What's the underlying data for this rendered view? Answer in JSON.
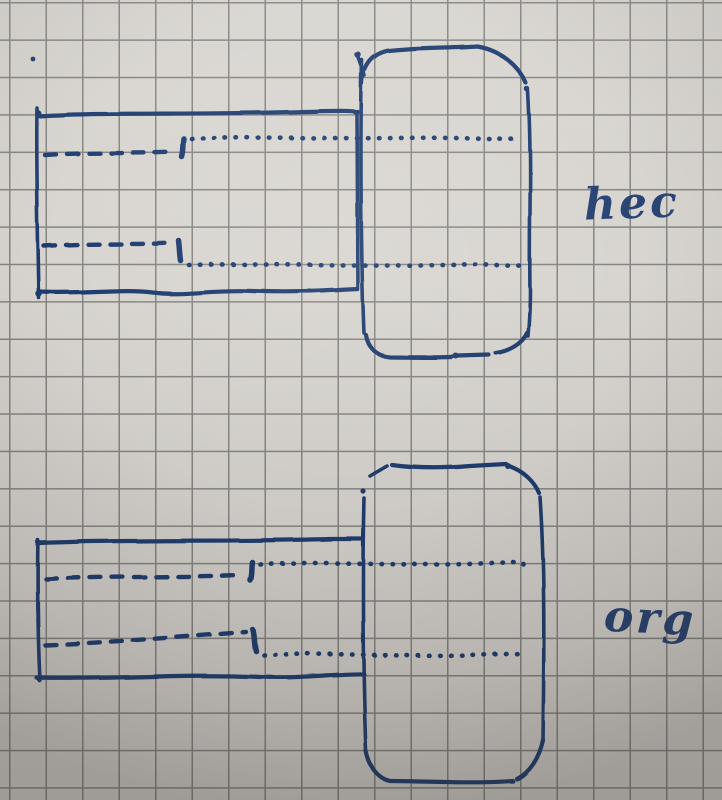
{
  "labels": {
    "top_figure": "hec",
    "bottom_figure": "org"
  },
  "colors": {
    "ink": "#1d3a6e",
    "paper": "#d9d6d1",
    "grid": "#85837f"
  }
}
